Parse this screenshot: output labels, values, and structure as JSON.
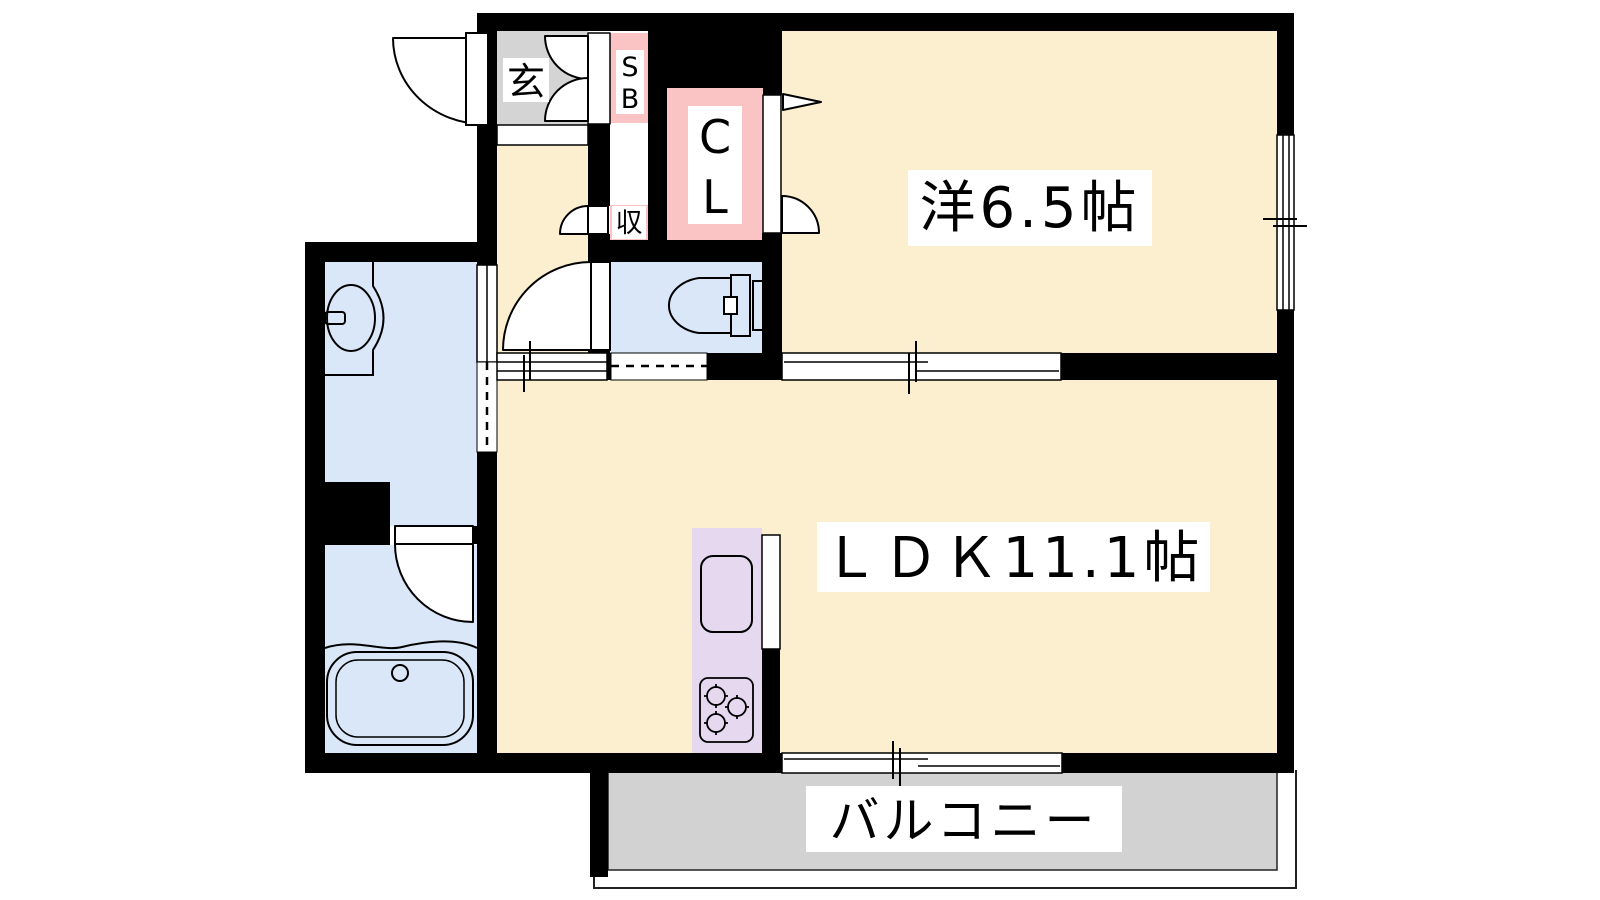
{
  "colors": {
    "wall": "#000000",
    "room_cream": "#FBEFD0",
    "wet_blue": "#D9E7F8",
    "closet_pink": "#FAC4C4",
    "entry_gray": "#D4D4D4",
    "balcony_gray": "#D2D2D2",
    "kitchen_lavender": "#E5D8EF",
    "label_bg": "#FFFFFF"
  },
  "rooms": {
    "genkan": {
      "label": "玄"
    },
    "shoe_box": {
      "label": "SB"
    },
    "closet": {
      "label": "CL"
    },
    "storage": {
      "label": "収"
    },
    "western": {
      "label": "洋6.5帖"
    },
    "ldk": {
      "label": "ＬＤＫ11.1帖"
    },
    "balcony": {
      "label": "バルコニー"
    }
  }
}
